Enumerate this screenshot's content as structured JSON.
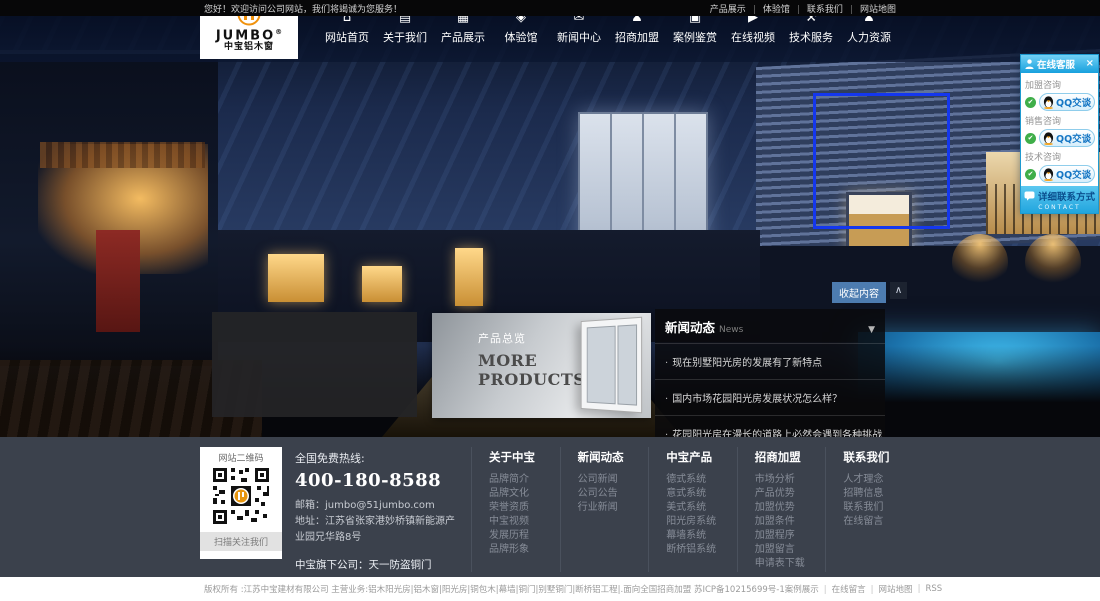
{
  "colors": {
    "qq_cyan": "#29aee3",
    "nav_navy": "#0c1a38",
    "footer_bg": "#3b414c",
    "logo_orange": "#f0920e",
    "highlight_blue": "#1437ee",
    "collapse_blue": "#4d7cb0"
  },
  "topbar": {
    "welcome": "您好！欢迎访问公司网站，我们将竭诚为您服务！",
    "links": [
      "产品展示",
      "体验馆",
      "联系我们",
      "网站地图"
    ]
  },
  "nav": {
    "logo": {
      "name": "JUMBO",
      "reg": "®",
      "sub": "中宝铝木窗"
    },
    "items": [
      {
        "label": "网站首页",
        "icon": "home-icon",
        "glyph": "⌂"
      },
      {
        "label": "关于我们",
        "icon": "book-icon",
        "glyph": "▤"
      },
      {
        "label": "产品展示",
        "icon": "grid-icon",
        "glyph": "▦"
      },
      {
        "label": "体验馆",
        "icon": "shield-icon",
        "glyph": "◈"
      },
      {
        "label": "新闻中心",
        "icon": "message-icon",
        "glyph": "✉"
      },
      {
        "label": "招商加盟",
        "icon": "user-plus-icon",
        "glyph": "♟"
      },
      {
        "label": "案例鉴赏",
        "icon": "photos-icon",
        "glyph": "▣"
      },
      {
        "label": "在线视频",
        "icon": "video-icon",
        "glyph": "▶"
      },
      {
        "label": "技术服务",
        "icon": "tools-icon",
        "glyph": "⚒"
      },
      {
        "label": "人力资源",
        "icon": "user-icon",
        "glyph": "♟"
      }
    ]
  },
  "qq": {
    "title": "在线客服",
    "close": "×",
    "check": "✔",
    "groups": [
      {
        "label": "加盟咨询",
        "button": "QQ交谈"
      },
      {
        "label": "销售咨询",
        "button": "QQ交谈"
      },
      {
        "label": "技术咨询",
        "button": "QQ交谈"
      }
    ],
    "footer_label": "详细联系方式",
    "footer_sub": "CONTACT"
  },
  "products_banner": {
    "title": "产品总览",
    "line1": "MORE",
    "line2": "PRODUCTS"
  },
  "collapse": {
    "label": "收起内容",
    "arrow": "∧"
  },
  "news": {
    "title": "新闻动态",
    "subtitle": "News",
    "arrow": "▼",
    "items": [
      "现在别墅阳光房的发展有了新特点",
      "国内市场花园阳光房发展状况怎么样？",
      "花园阳光房在漫长的道路上必然会遇到各种挑战"
    ]
  },
  "footer": {
    "qr": {
      "title": "网站二维码",
      "caption": "扫描关注我们"
    },
    "contact": {
      "hotline_label": "全国免费热线:",
      "hotline": "400-180-8588",
      "email": "邮箱：jumbo@51jumbo.com",
      "address": "地址：江苏省张家港妙桥镇新能源产业园兄华路8号",
      "subsidiary": "中宝旗下公司：天一防盗铜门"
    },
    "columns": [
      {
        "title": "关于中宝",
        "links": [
          "品牌简介",
          "品牌文化",
          "荣誉资质",
          "中宝视频",
          "发展历程",
          "品牌形象"
        ]
      },
      {
        "title": "新闻动态",
        "links": [
          "公司新闻",
          "公司公告",
          "行业新闻"
        ]
      },
      {
        "title": "中宝产品",
        "links": [
          "德式系统",
          "意式系统",
          "美式系统",
          "阳光房系统",
          "幕墙系统",
          "断桥铝系统"
        ]
      },
      {
        "title": "招商加盟",
        "links": [
          "市场分析",
          "产品优势",
          "加盟优势",
          "加盟条件",
          "加盟程序",
          "加盟留言",
          "申请表下载"
        ]
      },
      {
        "title": "联系我们",
        "links": [
          "人才理念",
          "招聘信息",
          "联系我们",
          "在线留言"
        ]
      }
    ]
  },
  "bottombar": {
    "copyright": "版权所有 :江苏中宝建材有限公司 主营业务:铝木阳光房|铝木窗|阳光房|铜包木|幕墙|铜门|别墅铜门|断桥铝工程|.面向全国招商加盟 苏ICP备10215699号-1",
    "links": [
      "案例展示",
      "在线留言",
      "网站地图",
      "RSS"
    ]
  }
}
